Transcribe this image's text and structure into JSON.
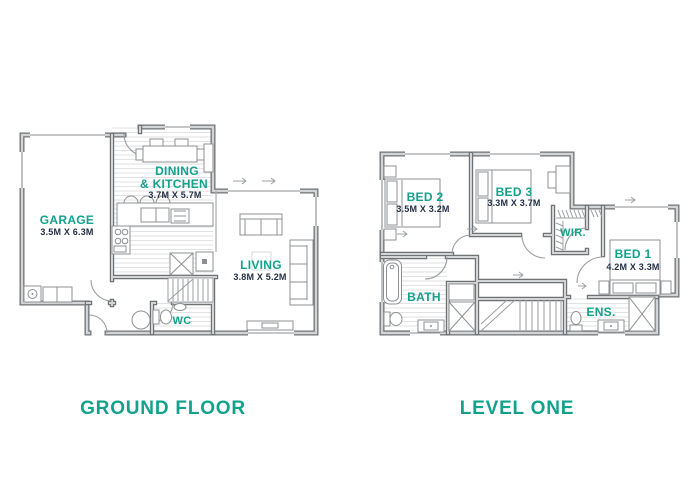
{
  "colors": {
    "label_teal": "#12a28b",
    "dims_navy": "#243046",
    "wall_gray": "#6f7376"
  },
  "ground_floor": {
    "title": "GROUND FLOOR",
    "rooms": {
      "garage": {
        "name": "GARAGE",
        "dims": "3.5M X 6.3M"
      },
      "dining_kitchen": {
        "line1": "DINING",
        "line2": "& KITCHEN",
        "dims": "3.7M X 5.7M"
      },
      "living": {
        "name": "LIVING",
        "dims": "3.8M X 5.2M"
      },
      "wc": {
        "name": "WC"
      }
    }
  },
  "level_one": {
    "title": "LEVEL ONE",
    "rooms": {
      "bed2": {
        "name": "BED 2",
        "dims": "3.5M X 3.2M"
      },
      "bed3": {
        "name": "BED 3",
        "dims": "3.3M X 3.7M"
      },
      "wir": {
        "name": "WIR."
      },
      "bed1": {
        "name": "BED 1",
        "dims": "4.2M X 3.3M"
      },
      "bath": {
        "name": "BATH"
      },
      "ens": {
        "name": "ENS."
      }
    }
  }
}
